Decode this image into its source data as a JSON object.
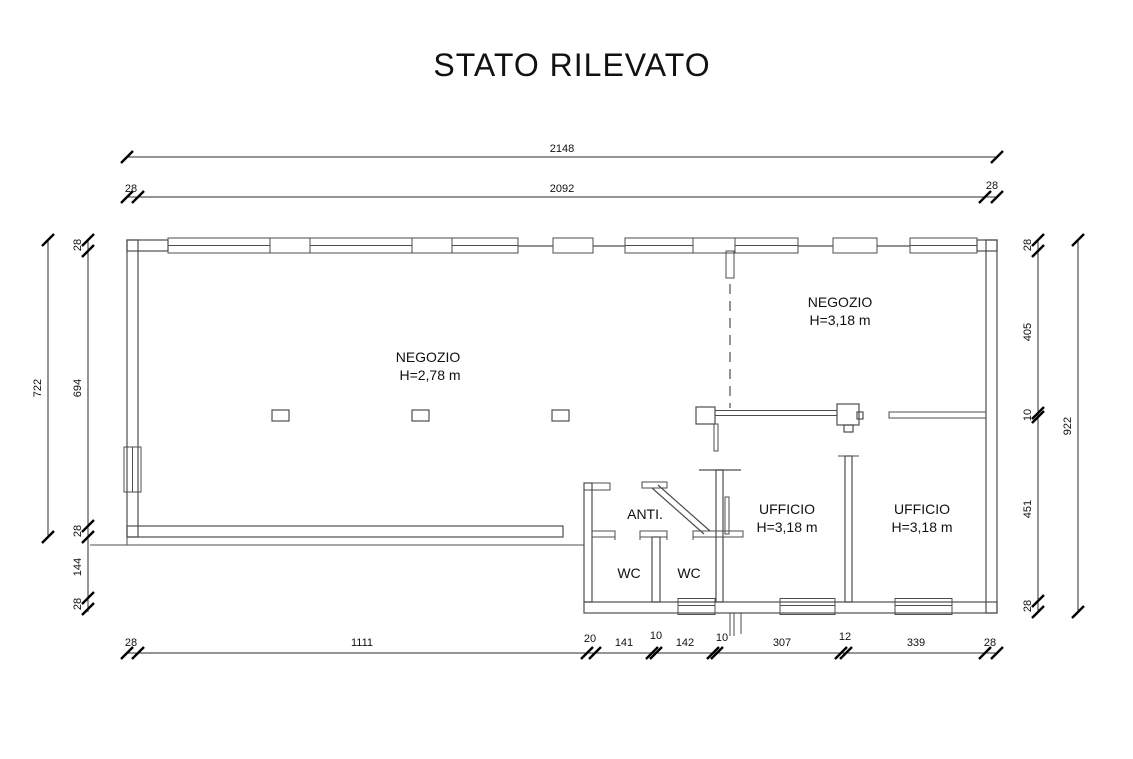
{
  "title": "STATO RILEVATO",
  "rooms": {
    "main": {
      "label": "NEGOZIO",
      "h": "H=2,78 m"
    },
    "right": {
      "label": "NEGOZIO",
      "h": "H=3,18 m"
    },
    "office1": {
      "label": "UFFICIO",
      "h": "H=3,18 m"
    },
    "office2": {
      "label": "UFFICIO",
      "h": "H=3,18 m"
    },
    "anti": {
      "label": "ANTI."
    },
    "wc1": {
      "label": "WC"
    },
    "wc2": {
      "label": "WC"
    }
  },
  "dims": {
    "top_overall": "2148",
    "top_inner": "2092",
    "top_wall_left": "28",
    "top_wall_right": "28",
    "left_outer": "722",
    "left": [
      "28",
      "694",
      "28",
      "144",
      "28"
    ],
    "right_outer": "922",
    "right": [
      "28",
      "405",
      "10",
      "451",
      "28"
    ],
    "bottom": [
      "28",
      "1111",
      "20",
      "141",
      "10",
      "142",
      "10",
      "307",
      "12",
      "339",
      "28"
    ]
  }
}
